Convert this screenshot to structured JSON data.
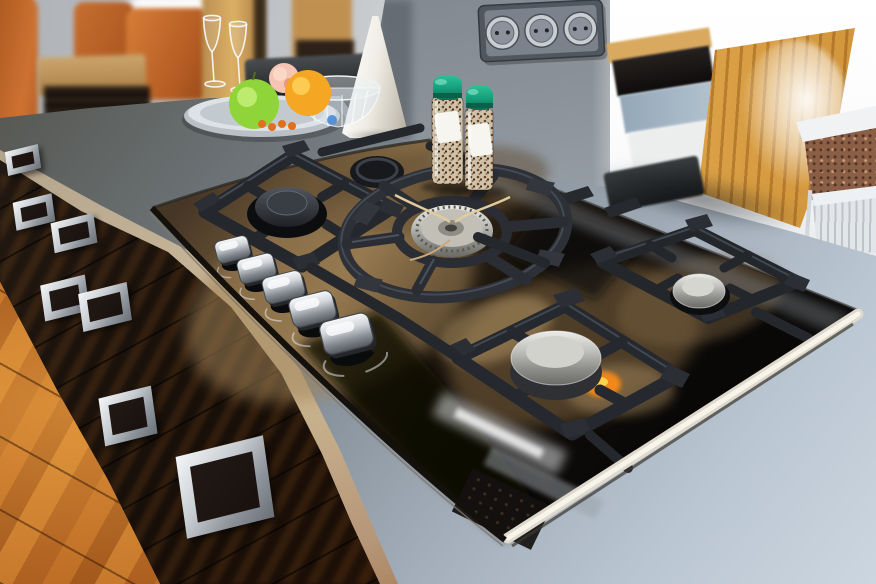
{
  "image_type": "photograph",
  "scene": {
    "description": "Modern kitchen island with a built-in black glass gas hob, blurred dining area behind and bar counter to the right",
    "setting": "kitchen interior",
    "objects": [
      {
        "name": "gas-cooktop",
        "details": "black glass surface with stainless front trim and cast-iron pan supports",
        "burner_count": 5,
        "knob_count": 5
      },
      {
        "name": "wok-burner",
        "details": "central round cast-iron wok ring with stainless burner head and ignition wires"
      },
      {
        "name": "burner-caps",
        "details": "two domed stainless caps on the right, one dark cap left, one small dark cap rear"
      },
      {
        "name": "control-knobs",
        "count": 5,
        "details": "silver chrome knobs in a diagonal row with white printed arcs"
      },
      {
        "name": "spice-grinders",
        "count": 2,
        "details": "glass pepper mills filled with peppercorns, green caps, white labels"
      },
      {
        "name": "power-sockets",
        "count": 3,
        "details": "triple round socket plate mounted on grey chimney column"
      },
      {
        "name": "fruit-platter",
        "details": "silver tray with green apple, orange, peach, small berries and a crystal bowl"
      },
      {
        "name": "wine-glasses",
        "count": 2
      },
      {
        "name": "white-cone-vase",
        "count": 1
      },
      {
        "name": "dining-area",
        "details": "orange leather chairs around a wooden table, blurred"
      },
      {
        "name": "island-drawers",
        "details": "dark glossy fronts reflecting the wood floor",
        "handle_count": 7
      },
      {
        "name": "wood-floor",
        "details": "glossy orange-brown plank flooring"
      },
      {
        "name": "bar-counter",
        "details": "glossy light wood panel on the right"
      },
      {
        "name": "radiator",
        "details": "white finned radiator below a speckled granite sill"
      },
      {
        "name": "flame-glow",
        "details": "small orange reflection on the glass near the front right burner"
      }
    ]
  },
  "colors": {
    "chair-orange": "#c2662c",
    "floor-mid": "#a3591d",
    "counter-light": "#ccd6e0",
    "glass-bronze": "#8a6f4b",
    "iron-dark": "#24272c",
    "steel-light": "#ececea",
    "cap-green": "#16a07c",
    "wood-bar": "#e2ae58",
    "glow-orange": "#ff8c12",
    "column-grey": "#7e858d",
    "wall-grey": "#b8bcc0"
  }
}
